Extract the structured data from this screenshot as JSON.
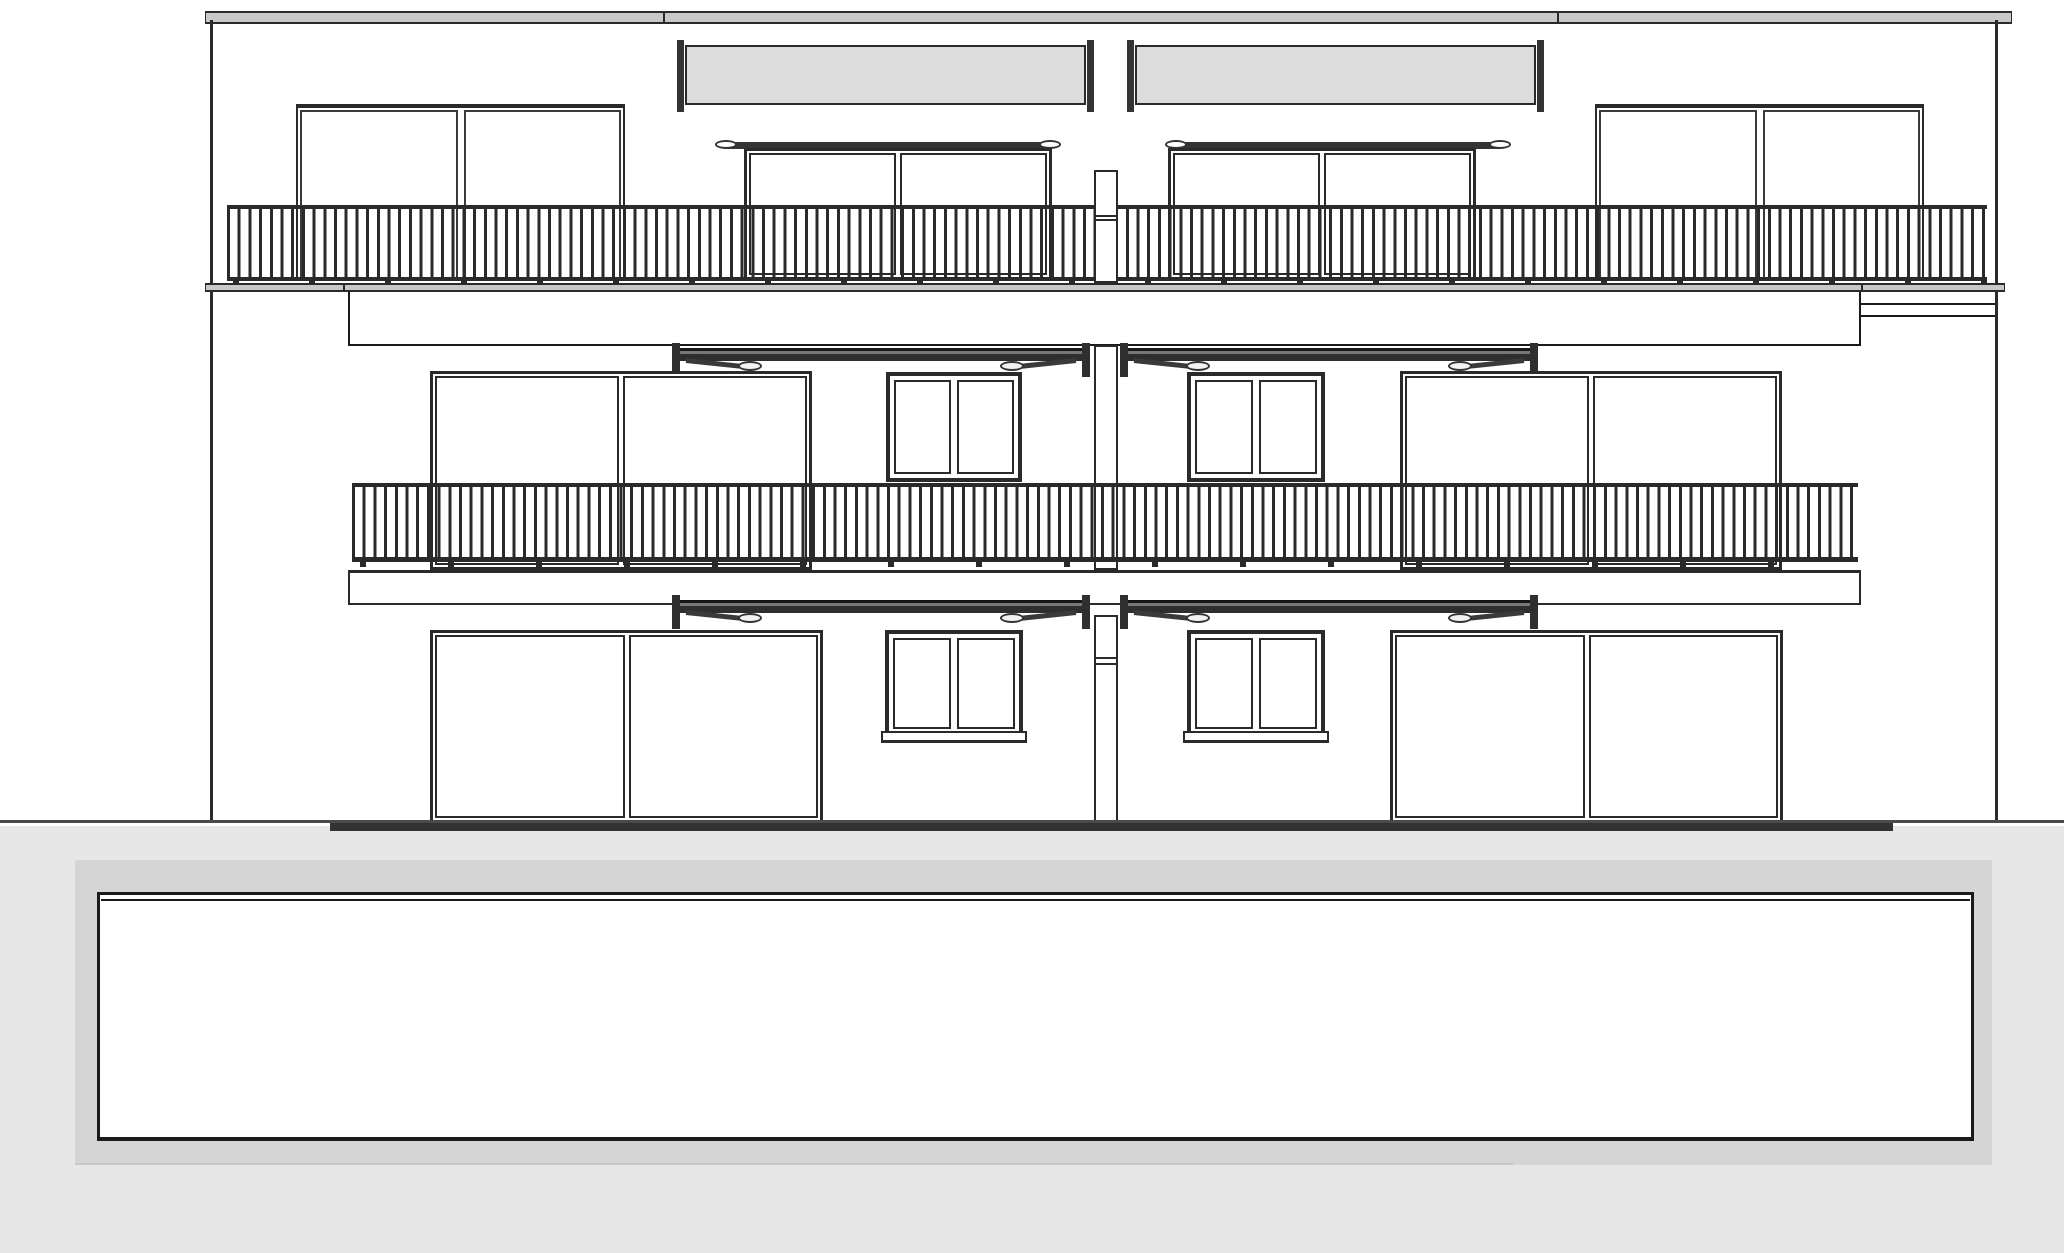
{
  "meta": {
    "description": "building-front-elevation-drawing",
    "floors": 3,
    "units": 2
  },
  "palette": {
    "line": "#2a2a2a",
    "line_dark": "#1a1a1a",
    "line_soft": "#3a3a3a",
    "slab_gray": "#c9c9c9",
    "awning_box_gray": "#dcdcdc",
    "awning_bar_dark": "#333333",
    "terrain_gray": "#e7e7e7",
    "basement_gray": "#d5d5d5",
    "white": "#ffffff"
  },
  "drawing": {
    "width": 2064,
    "height": 1253,
    "baluster": {
      "bar": 3,
      "pitch": 10.7
    },
    "elements": [
      {
        "t": "rect",
        "n": "terrain",
        "x": 0,
        "y": 826,
        "w": 2064,
        "h": 427,
        "f": "#e7e7e7"
      },
      {
        "t": "rect",
        "n": "basement-surround",
        "x": 75,
        "y": 860,
        "w": 1917,
        "h": 305,
        "f": "#d5d5d5"
      },
      {
        "t": "rect",
        "n": "basement-garage-box",
        "x": 97,
        "y": 892,
        "w": 1877,
        "h": 249,
        "f": "#ffffff",
        "s": "#1a1a1a",
        "b": [
          3,
          3,
          4,
          3
        ]
      },
      {
        "t": "rect",
        "n": "basement-box-top-line",
        "x": 101,
        "y": 899,
        "w": 1869,
        "h": 2,
        "f": "#1a1a1a"
      },
      {
        "t": "rect",
        "n": "basement-step-line",
        "x": 75,
        "y": 1163,
        "w": 1438,
        "h": 2,
        "f": "#c8c8c8"
      },
      {
        "t": "rect",
        "n": "roof-slab",
        "x": 205,
        "y": 11,
        "w": 1807,
        "h": 13,
        "f": "#c9c9c9",
        "s": "#2a2a2a",
        "b": [
          2,
          1,
          2,
          1
        ]
      },
      {
        "t": "rect",
        "n": "roof-joint-left",
        "x": 663,
        "y": 11,
        "w": 2,
        "h": 13,
        "f": "#2a2a2a"
      },
      {
        "t": "rect",
        "n": "roof-joint-right",
        "x": 1557,
        "y": 11,
        "w": 2,
        "h": 13,
        "f": "#2a2a2a"
      },
      {
        "t": "rect",
        "n": "left-wall",
        "x": 210,
        "y": 20,
        "w": 3,
        "h": 803,
        "f": "#2a2a2a"
      },
      {
        "t": "rect",
        "n": "right-wall",
        "x": 1995,
        "y": 20,
        "w": 3,
        "h": 803,
        "f": "#2a2a2a"
      },
      {
        "t": "panel",
        "n": "roof-glass-screen-left",
        "x": 296,
        "y": 104,
        "w": 329,
        "h": 176
      },
      {
        "t": "panel",
        "n": "roof-glass-screen-right",
        "x": 1595,
        "y": 104,
        "w": 329,
        "h": 176
      },
      {
        "t": "abox",
        "n": "roof-awning-cassette-left",
        "x": 677,
        "y": 40,
        "w": 417,
        "h": 112
      },
      {
        "t": "abox",
        "n": "roof-awning-cassette-right",
        "x": 1127,
        "y": 40,
        "w": 417,
        "h": 112
      },
      {
        "t": "door",
        "n": "roof-sliding-door-left",
        "x": 744,
        "y": 148,
        "w": 308,
        "h": 132
      },
      {
        "t": "door",
        "n": "roof-sliding-door-right",
        "x": 1168,
        "y": 148,
        "w": 308,
        "h": 132
      },
      {
        "t": "railing",
        "n": "roof-terrace-railing",
        "x": 227,
        "y": 205,
        "w": 1760,
        "h": 76,
        "rt": 4,
        "rb": 4
      },
      {
        "t": "rect",
        "n": "roof-terrace-slab",
        "x": 205,
        "y": 283,
        "w": 1800,
        "h": 9,
        "f": "#c9c9c9",
        "s": "#2a2a2a",
        "b": [
          2,
          1,
          2,
          1
        ]
      },
      {
        "t": "rect",
        "n": "slab-joint-left",
        "x": 343,
        "y": 283,
        "w": 2,
        "h": 9,
        "f": "#2a2a2a"
      },
      {
        "t": "rect",
        "n": "slab-joint-right",
        "x": 1861,
        "y": 283,
        "w": 2,
        "h": 9,
        "f": "#2a2a2a"
      },
      {
        "t": "feet",
        "n": "roof-railing-feet",
        "x": 233,
        "y": 277,
        "w": 1754,
        "h": 8,
        "sp": 76
      },
      {
        "t": "pillar",
        "n": "chimney-top",
        "x": 1094,
        "y": 170,
        "w": 24,
        "h": 113,
        "j": [
          43,
          47
        ]
      },
      {
        "t": "rect",
        "n": "upper-fascia-band",
        "x": 348,
        "y": 292,
        "w": 1513,
        "h": 54,
        "f": "#ffffff",
        "s": "#1a1a1a",
        "b": [
          0,
          2,
          2,
          2
        ]
      },
      {
        "t": "rect",
        "n": "upper-fascia-right",
        "x": 1861,
        "y": 292,
        "w": 134,
        "h": 25,
        "f": "#ffffff",
        "s": "#1a1a1a",
        "b": [
          0,
          0,
          2,
          0
        ]
      },
      {
        "t": "rect",
        "n": "upper-fascia-right-line",
        "x": 1861,
        "y": 303,
        "w": 134,
        "h": 2,
        "f": "#1a1a1a"
      },
      {
        "t": "aext",
        "n": "middle-awning-left",
        "x": 672,
        "y": 343,
        "w": 418,
        "h": 34
      },
      {
        "t": "aext",
        "n": "middle-awning-right",
        "x": 1120,
        "y": 343,
        "w": 418,
        "h": 34
      },
      {
        "t": "door",
        "n": "middle-sliding-door-left",
        "x": 430,
        "y": 371,
        "w": 382,
        "h": 199
      },
      {
        "t": "window",
        "n": "middle-window-left",
        "x": 886,
        "y": 372,
        "w": 136,
        "h": 110
      },
      {
        "t": "window",
        "n": "middle-window-right",
        "x": 1187,
        "y": 372,
        "w": 138,
        "h": 110
      },
      {
        "t": "door",
        "n": "middle-sliding-door-right",
        "x": 1400,
        "y": 371,
        "w": 382,
        "h": 199
      },
      {
        "t": "pillar",
        "n": "chimney-middle",
        "x": 1094,
        "y": 345,
        "w": 24,
        "h": 225,
        "j": []
      },
      {
        "t": "railing",
        "n": "middle-balcony-railing",
        "x": 352,
        "y": 483,
        "w": 1506,
        "h": 79,
        "rt": 4,
        "rb": 5
      },
      {
        "t": "feet",
        "n": "middle-railing-feet",
        "x": 360,
        "y": 558,
        "w": 1490,
        "h": 9,
        "sp": 88
      },
      {
        "t": "rect",
        "n": "middle-balcony-slab",
        "x": 348,
        "y": 570,
        "w": 1513,
        "h": 35,
        "f": "#ffffff",
        "s": "#2a2a2a",
        "b": [
          3,
          2,
          2,
          2
        ]
      },
      {
        "t": "aext",
        "n": "ground-awning-left",
        "x": 672,
        "y": 595,
        "w": 418,
        "h": 34
      },
      {
        "t": "aext",
        "n": "ground-awning-right",
        "x": 1120,
        "y": 595,
        "w": 418,
        "h": 34
      },
      {
        "t": "door",
        "n": "ground-sliding-door-left",
        "x": 430,
        "y": 630,
        "w": 393,
        "h": 193
      },
      {
        "t": "window",
        "n": "ground-window-left",
        "x": 885,
        "y": 630,
        "w": 138,
        "h": 107
      },
      {
        "t": "rect",
        "n": "ground-window-left-sill",
        "x": 881,
        "y": 731,
        "w": 146,
        "h": 12,
        "f": "#ffffff",
        "s": "#2a2a2a",
        "b": [
          2,
          2,
          3,
          2
        ]
      },
      {
        "t": "window",
        "n": "ground-window-right",
        "x": 1187,
        "y": 630,
        "w": 138,
        "h": 107
      },
      {
        "t": "rect",
        "n": "ground-window-right-sill",
        "x": 1183,
        "y": 731,
        "w": 146,
        "h": 12,
        "f": "#ffffff",
        "s": "#2a2a2a",
        "b": [
          2,
          2,
          3,
          2
        ]
      },
      {
        "t": "door",
        "n": "ground-sliding-door-right",
        "x": 1390,
        "y": 630,
        "w": 393,
        "h": 193
      },
      {
        "t": "pillar",
        "n": "chimney-ground",
        "x": 1094,
        "y": 615,
        "w": 24,
        "h": 208,
        "j": [
          40,
          46
        ]
      },
      {
        "t": "rect",
        "n": "ground-line",
        "x": 0,
        "y": 820,
        "w": 2064,
        "h": 3,
        "f": "#4a4a4a"
      },
      {
        "t": "rect",
        "n": "ground-line-footprint",
        "x": 330,
        "y": 823,
        "w": 1563,
        "h": 8,
        "f": "#333333"
      }
    ]
  }
}
